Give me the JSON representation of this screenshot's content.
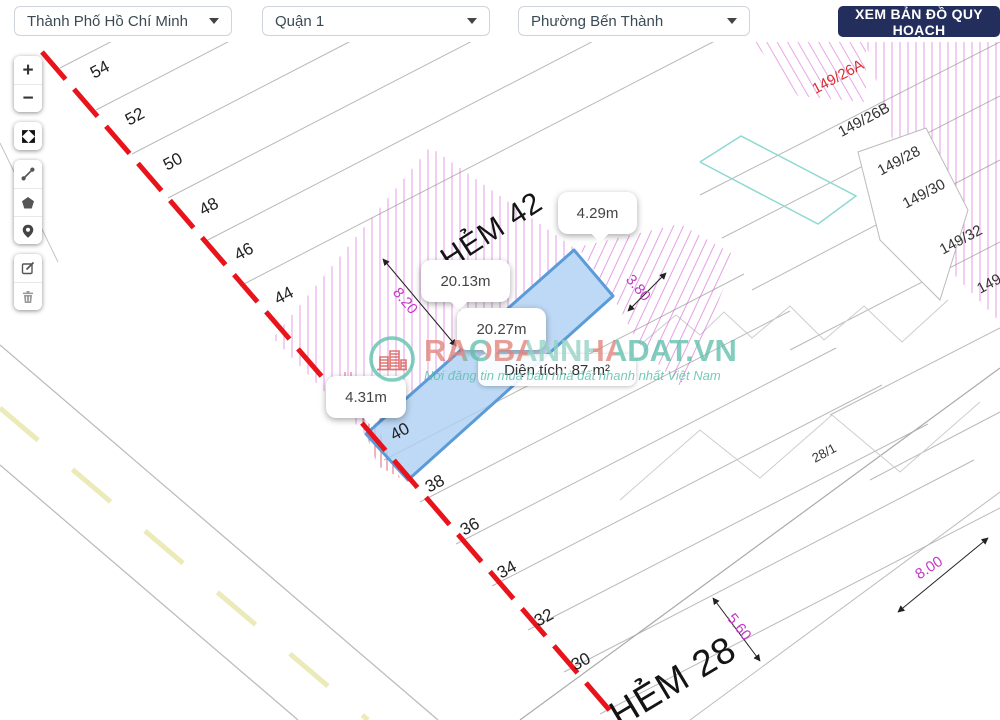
{
  "header": {
    "city_select": {
      "value": "Thành Phố Hồ Chí Minh"
    },
    "district_select": {
      "value": "Quận 1"
    },
    "ward_select": {
      "value": "Phường Bến Thành"
    },
    "planning_button": "XEM BẢN ĐỒ QUY HOẠCH"
  },
  "toolbar": {
    "zoom_in": "+",
    "zoom_out": "−",
    "icons": [
      "fullscreen-icon",
      "measure-distance-icon",
      "draw-polygon-icon",
      "marker-icon",
      "edit-icon",
      "trash-icon"
    ]
  },
  "map": {
    "street_labels": [
      {
        "text": "HẺM 42"
      },
      {
        "text": "HẺM 28"
      }
    ],
    "parcel_numbers": [
      {
        "text": "54"
      },
      {
        "text": "52"
      },
      {
        "text": "50"
      },
      {
        "text": "48"
      },
      {
        "text": "46"
      },
      {
        "text": "44"
      },
      {
        "text": "40"
      },
      {
        "text": "38"
      },
      {
        "text": "36"
      },
      {
        "text": "34"
      },
      {
        "text": "32"
      },
      {
        "text": "30"
      }
    ],
    "house_numbers": [
      {
        "text": "149/26A",
        "color": "#d63031"
      },
      {
        "text": "149/26B",
        "color": "#333333"
      },
      {
        "text": "149/28",
        "color": "#333333"
      },
      {
        "text": "149/30",
        "color": "#333333"
      },
      {
        "text": "149/32",
        "color": "#333333"
      },
      {
        "text": "149/",
        "color": "#333333"
      },
      {
        "text": "28/1",
        "color": "#444444"
      }
    ],
    "dimension_labels": [
      {
        "text": "8.20"
      },
      {
        "text": "3.80"
      },
      {
        "text": "5.60"
      },
      {
        "text": "8.00"
      }
    ],
    "measurement_tooltips": [
      {
        "text": "4.29m"
      },
      {
        "text": "20.13m"
      },
      {
        "text": "20.27m"
      },
      {
        "text": "4.31m"
      }
    ],
    "area_label": "Diện tích: 87 m²",
    "colors": {
      "selected_parcel_fill": "#aed0f2",
      "selected_parcel_stroke": "#5a9bd8",
      "boundary_red": "#e8131b",
      "hatch_magenta": "#d24fd2",
      "dimension_magenta": "#c23bc2"
    }
  },
  "watermark": {
    "brand": "RAOBANNHADAT.VN",
    "tagline": "Nơi đăng tin mua bán nhà đất nhanh nhất Việt Nam"
  }
}
